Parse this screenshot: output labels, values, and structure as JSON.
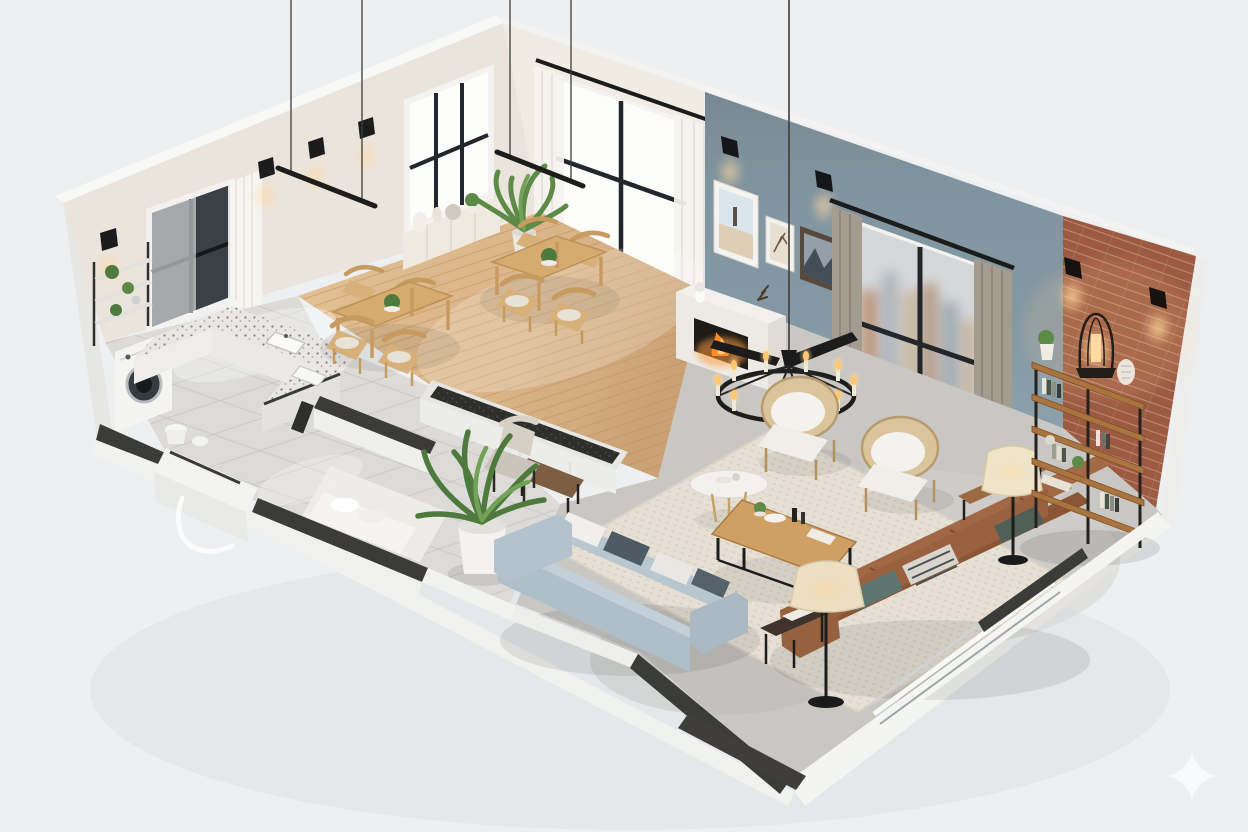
{
  "scene": {
    "description": "3D isometric cutaway render of an open-plan apartment floor plan, viewed from above at an angle",
    "style": "photorealistic architectural visualization, no visible text",
    "rooms": [
      "kitchen",
      "dining-area",
      "living-room",
      "entry-hall"
    ]
  },
  "items": [
    "u-shaped-terrazzo-kitchen-counter",
    "kitchen-sinks",
    "washing-machine",
    "wall-shelf-with-plants",
    "dining-table-set-left",
    "dining-table-set-right",
    "sideboard-with-vases",
    "tall-potted-plant",
    "linear-pendant-lights",
    "ceiling-suspension-wires",
    "wall-sconces",
    "blue-accent-wall",
    "framed-artworks",
    "fireplace-with-fire",
    "city-view-window",
    "grey-curtains",
    "white-curtains",
    "brick-feature-wall",
    "industrial-bookshelf",
    "lantern-lamp",
    "black-iron-candle-chandelier",
    "rattan-armchair-left",
    "rattan-armchair-right",
    "round-marble-side-table",
    "wooden-coffee-table",
    "cream-area-rug",
    "light-blue-sofa",
    "brown-leather-sofa",
    "black-side-table",
    "floor-lamp-front",
    "floor-lamp-right",
    "console-behind-sofa",
    "palm-plant",
    "entry-bench",
    "desk-and-chair",
    "sliding-glass-door",
    "entry-door-arc"
  ],
  "palette": {
    "background": "#edeff1",
    "outer_wall": "#f5f5f4",
    "wall_cream": "#eae4dc",
    "wall_cream_light": "#f0ebe3",
    "wall_blue": "#8196a1",
    "wall_brick": "#9c5a42",
    "floor_wood": "#dcb98d",
    "floor_tile": "#dcdbd8",
    "floor_concrete": "#c9c7c3",
    "rug": "#e6e0d4",
    "sofa_blue": "#aebfc9",
    "sofa_leather": "#9a6140",
    "wood_furniture": "#cfa064",
    "counter_terrazzo": "#e9e7e3",
    "dark_trim": "#3a3a38",
    "black_metal": "#1f1f1f",
    "curtain_grey": "#a59c90",
    "curtain_white": "#f4f2ee",
    "plant_green": "#5d8a46",
    "glow_warm": "#ffd9a0",
    "marble": "#f3f1ed",
    "lamp_shade": "#ecdfc2"
  },
  "watermark": {
    "icon": "sparkle-icon",
    "color": "#f8f9fa"
  }
}
